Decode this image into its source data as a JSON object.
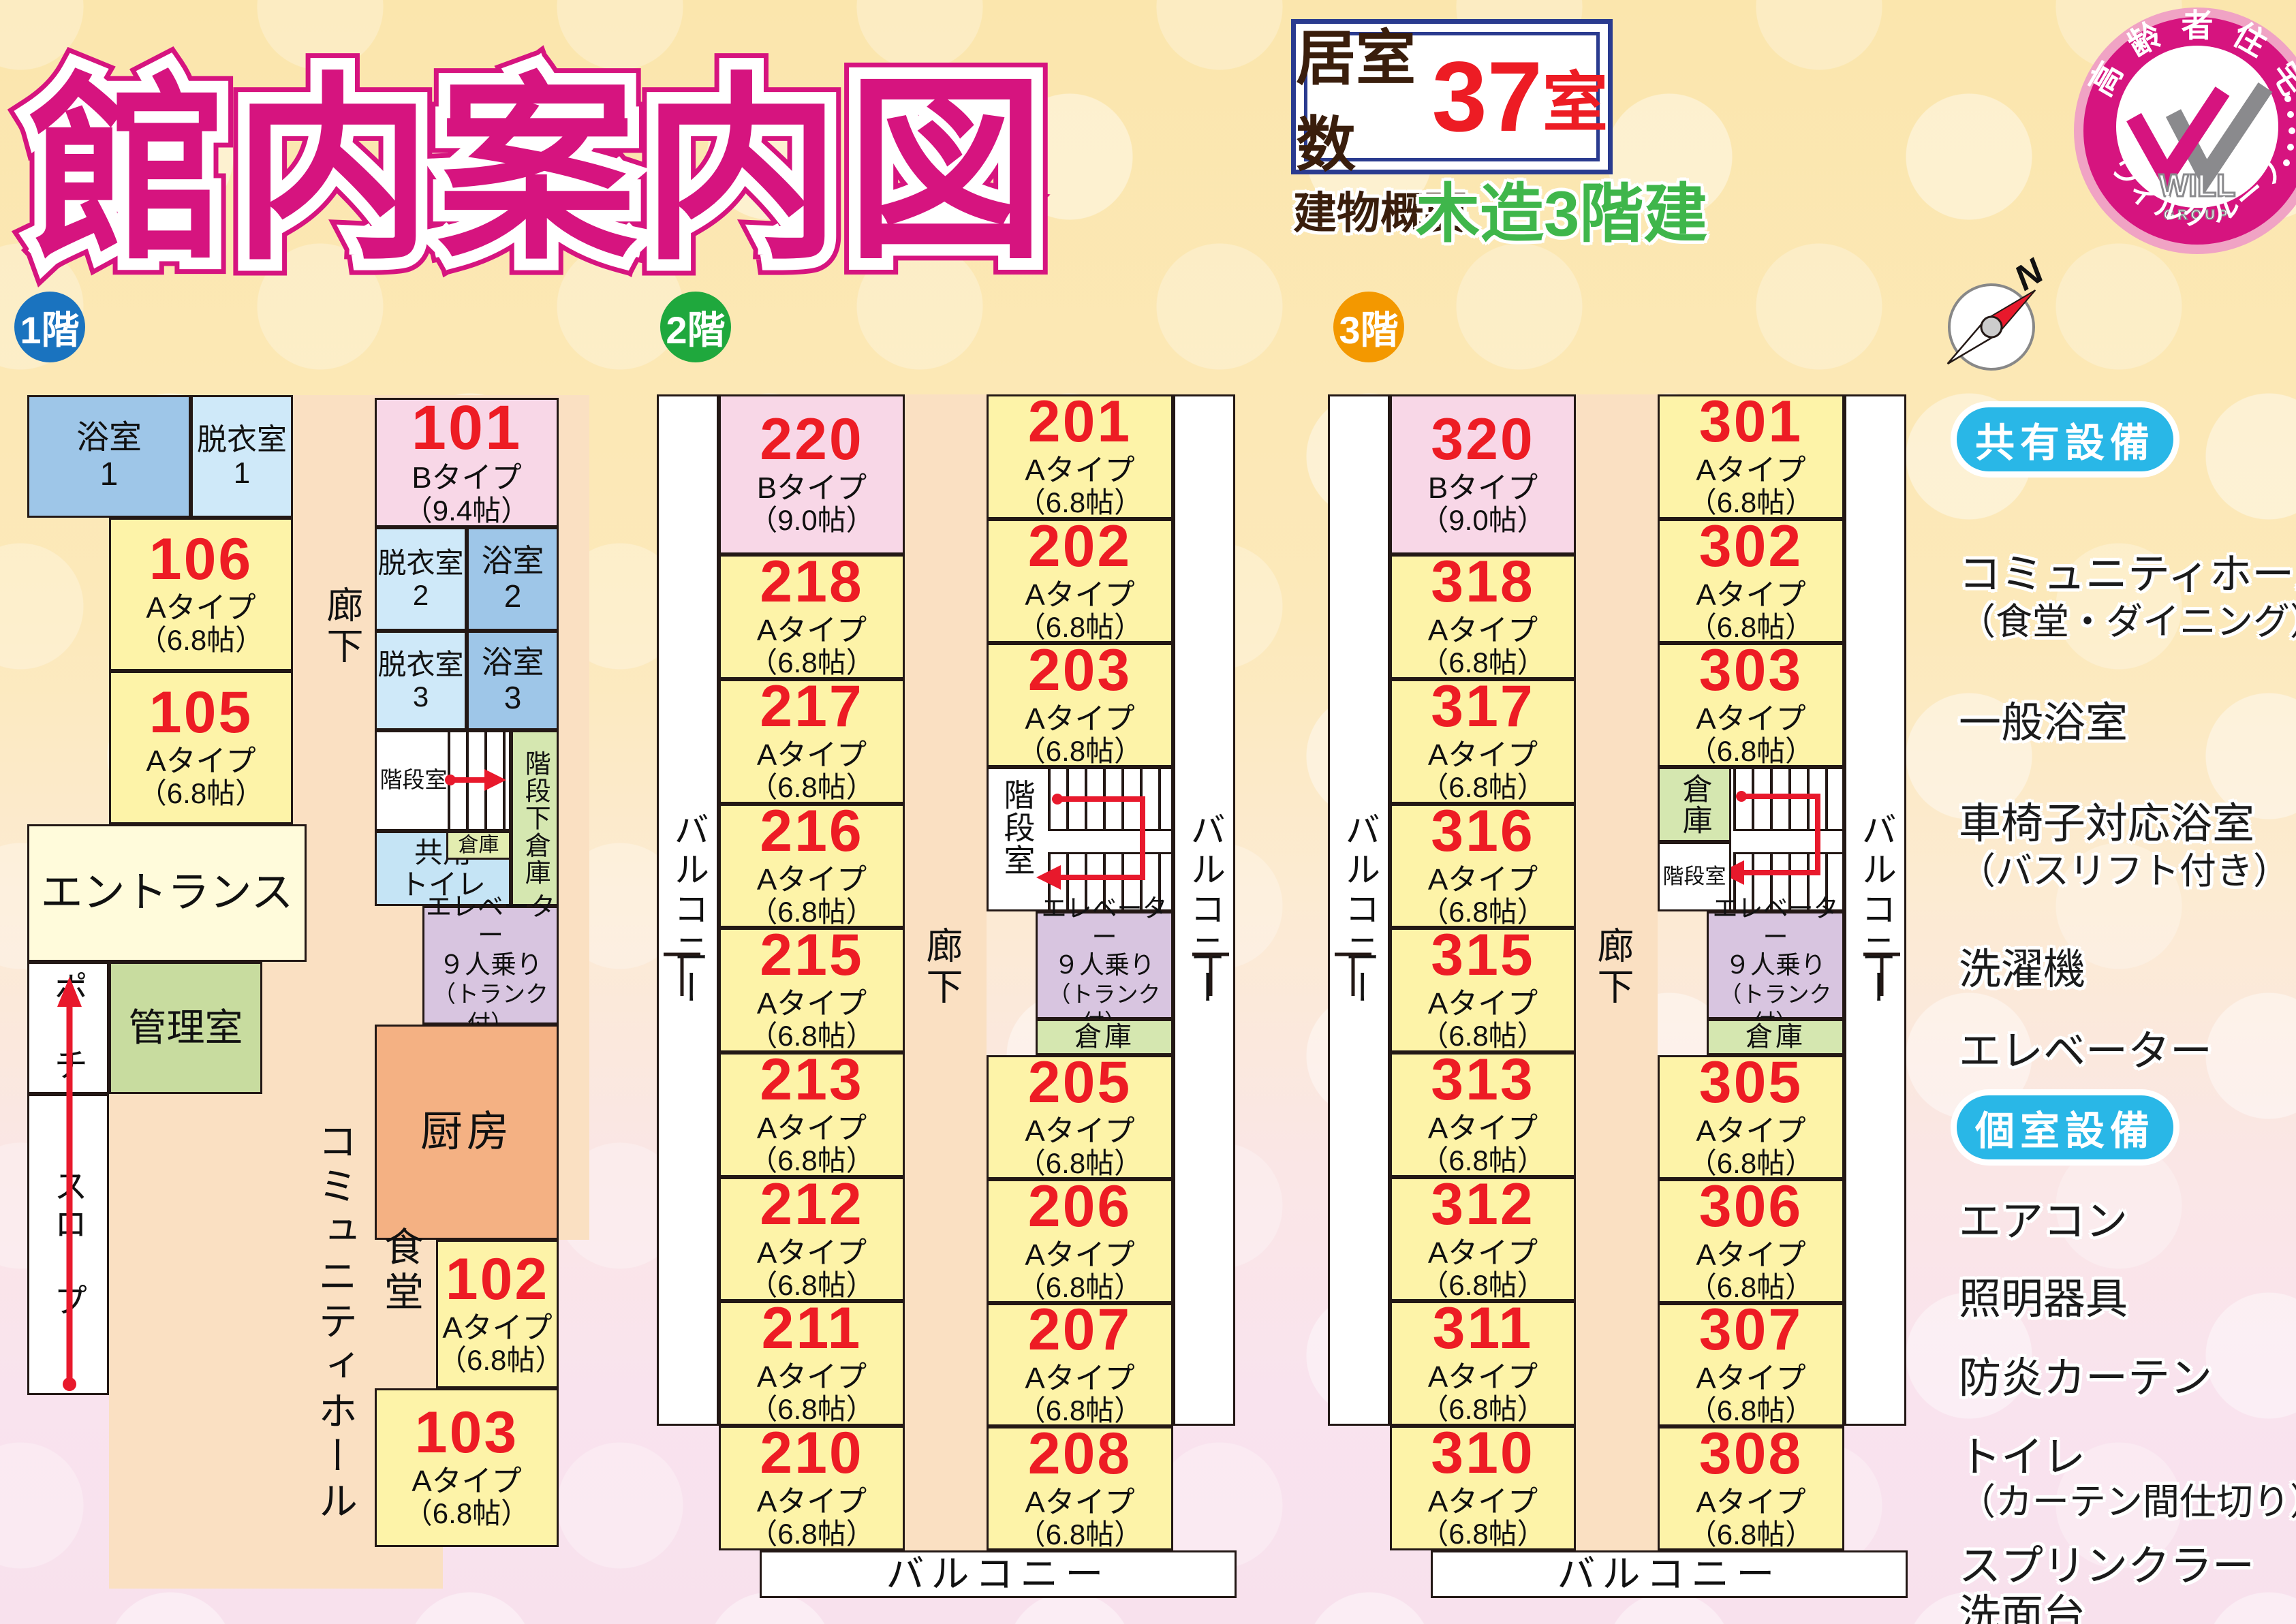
{
  "title": "館内案内図",
  "info": {
    "rooms_label": "居室数",
    "rooms_count": "37",
    "rooms_unit": "室",
    "building_label": "建物概要",
    "building_value": "木造3階建"
  },
  "badge": {
    "arc_top_chars": [
      "高",
      "齢",
      "者",
      "住",
      "宅"
    ],
    "brand": "WILL",
    "brand_sub": "GROUP",
    "arc_bottom_chars": [
      "ウ",
      "ィ",
      "ル",
      "グ",
      "ル",
      "ー",
      "プ"
    ]
  },
  "compass": {
    "north": "N"
  },
  "shared": {
    "corridor": "廊下",
    "balcony": "バルコニー",
    "stair_room": "階段室",
    "storage": "倉庫",
    "under_stair_storage": "階段下倉庫",
    "elevator_line1": "エレベーター",
    "elevator_line2": "９人乗り",
    "elevator_line3": "（トランク付）"
  },
  "floor1": {
    "label": "1階",
    "bath": "浴室",
    "undress": "脱衣室",
    "unit1": "1",
    "unit2": "2",
    "unit3": "3",
    "entrance": "エントランス",
    "porch": "ポーチ",
    "office": "管理室",
    "slope": "スロープ",
    "hall": "コミュニティホール",
    "dining": "食堂",
    "kitchen": "厨房",
    "shared_toilet_line1": "共用",
    "shared_toilet_line2": "トイレ",
    "rooms": [
      {
        "no": "101",
        "type": "Bタイプ",
        "size": "（9.4帖）"
      },
      {
        "no": "106",
        "type": "Aタイプ",
        "size": "（6.8帖）"
      },
      {
        "no": "105",
        "type": "Aタイプ",
        "size": "（6.8帖）"
      },
      {
        "no": "102",
        "type": "Aタイプ",
        "size": "（6.8帖）"
      },
      {
        "no": "103",
        "type": "Aタイプ",
        "size": "（6.8帖）"
      }
    ]
  },
  "floor2": {
    "label": "2階",
    "left_rooms": [
      {
        "no": "220",
        "type": "Bタイプ",
        "size": "（9.0帖）"
      },
      {
        "no": "218",
        "type": "Aタイプ",
        "size": "（6.8帖）"
      },
      {
        "no": "217",
        "type": "Aタイプ",
        "size": "（6.8帖）"
      },
      {
        "no": "216",
        "type": "Aタイプ",
        "size": "（6.8帖）"
      },
      {
        "no": "215",
        "type": "Aタイプ",
        "size": "（6.8帖）"
      },
      {
        "no": "213",
        "type": "Aタイプ",
        "size": "（6.8帖）"
      },
      {
        "no": "212",
        "type": "Aタイプ",
        "size": "（6.8帖）"
      },
      {
        "no": "211",
        "type": "Aタイプ",
        "size": "（6.8帖）"
      },
      {
        "no": "210",
        "type": "Aタイプ",
        "size": "（6.8帖）"
      }
    ],
    "right_rooms_top": [
      {
        "no": "201",
        "type": "Aタイプ",
        "size": "（6.8帖）"
      },
      {
        "no": "202",
        "type": "Aタイプ",
        "size": "（6.8帖）"
      },
      {
        "no": "203",
        "type": "Aタイプ",
        "size": "（6.8帖）"
      }
    ],
    "right_rooms_bottom": [
      {
        "no": "205",
        "type": "Aタイプ",
        "size": "（6.8帖）"
      },
      {
        "no": "206",
        "type": "Aタイプ",
        "size": "（6.8帖）"
      },
      {
        "no": "207",
        "type": "Aタイプ",
        "size": "（6.8帖）"
      },
      {
        "no": "208",
        "type": "Aタイプ",
        "size": "（6.8帖）"
      }
    ]
  },
  "floor3": {
    "label": "3階",
    "left_rooms": [
      {
        "no": "320",
        "type": "Bタイプ",
        "size": "（9.0帖）"
      },
      {
        "no": "318",
        "type": "Aタイプ",
        "size": "（6.8帖）"
      },
      {
        "no": "317",
        "type": "Aタイプ",
        "size": "（6.8帖）"
      },
      {
        "no": "316",
        "type": "Aタイプ",
        "size": "（6.8帖）"
      },
      {
        "no": "315",
        "type": "Aタイプ",
        "size": "（6.8帖）"
      },
      {
        "no": "313",
        "type": "Aタイプ",
        "size": "（6.8帖）"
      },
      {
        "no": "312",
        "type": "Aタイプ",
        "size": "（6.8帖）"
      },
      {
        "no": "311",
        "type": "Aタイプ",
        "size": "（6.8帖）"
      },
      {
        "no": "310",
        "type": "Aタイプ",
        "size": "（6.8帖）"
      }
    ],
    "right_rooms_top": [
      {
        "no": "301",
        "type": "Aタイプ",
        "size": "（6.8帖）"
      },
      {
        "no": "302",
        "type": "Aタイプ",
        "size": "（6.8帖）"
      },
      {
        "no": "303",
        "type": "Aタイプ",
        "size": "（6.8帖）"
      }
    ],
    "right_rooms_bottom": [
      {
        "no": "305",
        "type": "Aタイプ",
        "size": "（6.8帖）"
      },
      {
        "no": "306",
        "type": "Aタイプ",
        "size": "（6.8帖）"
      },
      {
        "no": "307",
        "type": "Aタイプ",
        "size": "（6.8帖）"
      },
      {
        "no": "308",
        "type": "Aタイプ",
        "size": "（6.8帖）"
      }
    ]
  },
  "legend": {
    "shared_title": "共有設備",
    "shared_items": [
      {
        "main": "コミュニティホール",
        "sub": "（食堂・ダイニング）"
      },
      {
        "main": "一般浴室"
      },
      {
        "main": "車椅子対応浴室",
        "sub": "（バスリフト付き）"
      },
      {
        "main": "洗濯機"
      },
      {
        "main": "エレベーター"
      }
    ],
    "private_title": "個室設備",
    "private_items": [
      {
        "main": "エアコン"
      },
      {
        "main": "照明器具"
      },
      {
        "main": "防炎カーテン"
      },
      {
        "main": "トイレ",
        "sub": "（カーテン間仕切り）"
      },
      {
        "main": "スプリンクラー"
      },
      {
        "main": "洗面台"
      }
    ]
  },
  "colors": {
    "title": "#d6147f",
    "room_number": "#ed1c24",
    "floor1_badge": "#1a73bf",
    "floor2_badge": "#1fa83d",
    "floor3_badge": "#f39800",
    "legend_pill": "#29b7e7",
    "b_type_room": "#f8d7e7",
    "a_type_room": "#fdf3a8"
  }
}
